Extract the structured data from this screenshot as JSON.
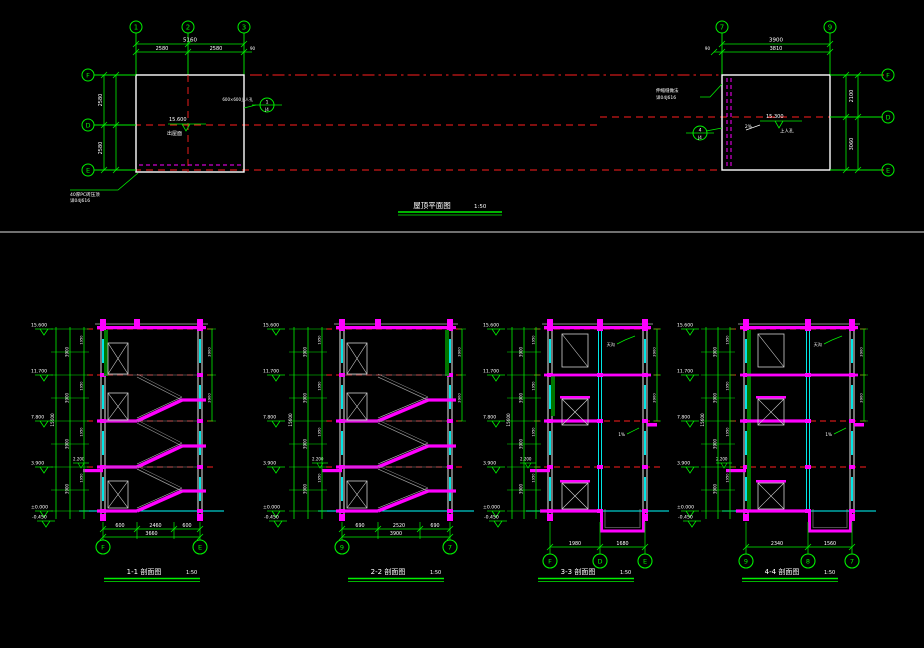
{
  "colors": {
    "bg": "#000000",
    "green": "#00f000",
    "red": "#ff1e1e",
    "magenta": "#ff00ff",
    "cyan": "#00ffff",
    "white": "#ffffff",
    "gray": "#aaaaaa",
    "dark_green": "#007700",
    "divider": "#b4b4b4"
  },
  "plan": {
    "title": "屋顶平面图",
    "scale": "1:50",
    "left": {
      "top_bubbles": [
        "1",
        "2",
        "3"
      ],
      "dim_total": "5160",
      "dim_segs": [
        "2580",
        "2580"
      ],
      "dim_off": "90",
      "side_bubbles": [
        "F",
        "D",
        "E"
      ],
      "side_dims": [
        "2580",
        "2580"
      ],
      "level_value": "15.600",
      "level_note": "出屋面",
      "detail_num": "1",
      "detail_ref": "J4",
      "detail_note": "600×600上人孔",
      "leader_line1": "40厚PC砖压顶",
      "leader_line2": "详04J616"
    },
    "right": {
      "top_bubbles": [
        "7",
        "9"
      ],
      "dim_total": "3900",
      "dim_seg": "3810",
      "dim_off": "90",
      "side_bubbles": [
        "F",
        "D",
        "E"
      ],
      "side_dims": [
        "2100",
        "3060"
      ],
      "level_value": "15.300",
      "slope": "2%",
      "level_note": "上人孔",
      "detail_num": "4",
      "detail_ref": "J4",
      "leader_line1": "伸缩缝做法",
      "leader_line2": "详04J616"
    }
  },
  "sections": [
    {
      "title": "1-1 剖面图",
      "scale": "1:50",
      "bubbles": [
        "F",
        "E"
      ],
      "bottom_segs": [
        "600",
        "2460",
        "600"
      ],
      "bottom_total": "3660",
      "elevations": [
        "15.600",
        "11.700",
        "7.800",
        "3.900",
        "±0.000"
      ],
      "base_elevation": "-0.450",
      "storey_dim": "3900",
      "half_dim": "1950",
      "total_dim": "15600",
      "entry_level": "2.200",
      "right_dim": "3900"
    },
    {
      "title": "2-2 剖面图",
      "scale": "1:50",
      "bubbles": [
        "9",
        "7"
      ],
      "bottom_segs": [
        "690",
        "2520",
        "690"
      ],
      "bottom_total": "3900",
      "elevations": [
        "15.600",
        "11.700",
        "7.800",
        "3.900",
        "±0.000"
      ],
      "base_elevation": "-0.450",
      "storey_dim": "3900",
      "half_dim": "1950",
      "total_dim": "15600",
      "entry_level": "2.200",
      "right_dim": "3900"
    },
    {
      "title": "3-3 剖面图",
      "scale": "1:50",
      "bubbles": [
        "F",
        "D",
        "E"
      ],
      "bottom_segs": [
        "1980",
        "1680"
      ],
      "bottom_total": "3660",
      "elevations": [
        "15.600",
        "11.700",
        "7.800",
        "3.900",
        "±0.000"
      ],
      "base_elevation": "-0.450",
      "storey_dim": "3900",
      "half_dim": "1950",
      "total_dim": "15600",
      "entry_level": "2.200",
      "right_dim": "3900",
      "notes": [
        "天沟",
        "1%"
      ]
    },
    {
      "title": "4-4 剖面图",
      "scale": "1:50",
      "bubbles": [
        "9",
        "8",
        "7"
      ],
      "bottom_segs": [
        "2340",
        "1560"
      ],
      "bottom_total": "3900",
      "elevations": [
        "15.600",
        "11.700",
        "7.800",
        "3.900",
        "±0.000"
      ],
      "base_elevation": "-0.450",
      "storey_dim": "3900",
      "half_dim": "1950",
      "total_dim": "15600",
      "entry_level": "2.200",
      "right_dim": "3900",
      "notes": [
        "天沟",
        "1%"
      ]
    }
  ]
}
